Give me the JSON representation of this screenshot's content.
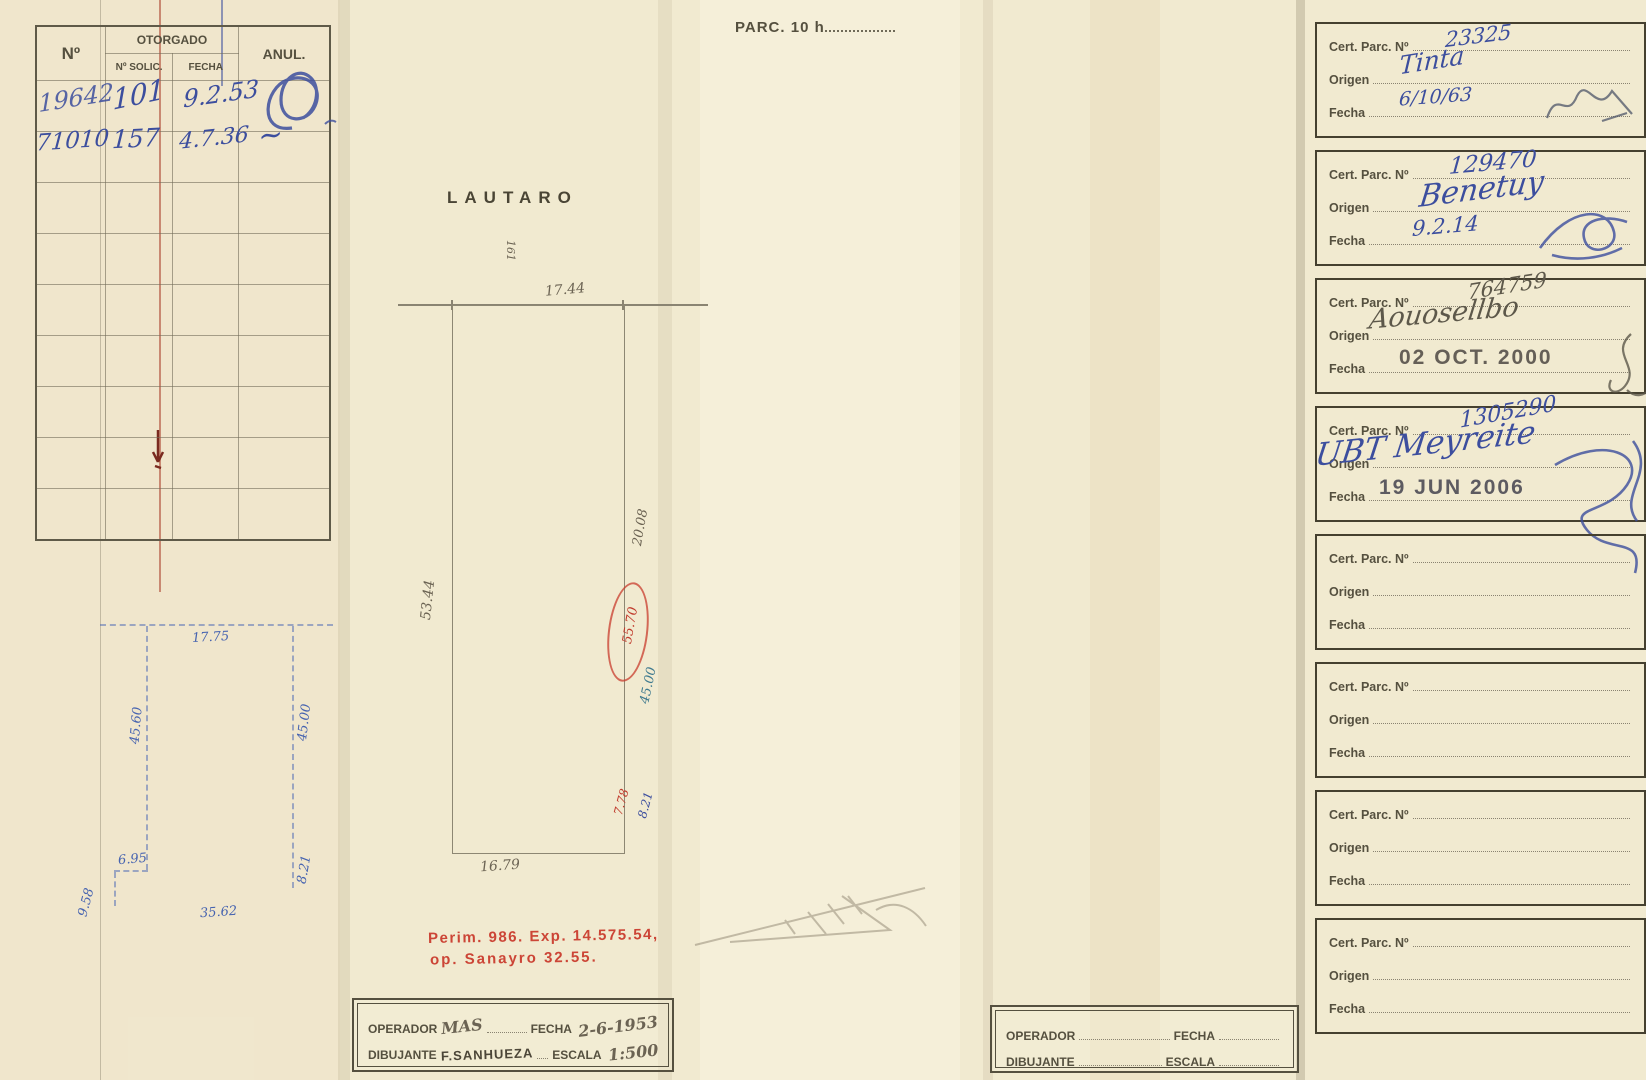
{
  "page": {
    "title": "PARC. 10 h",
    "street_label": "LAUTARO"
  },
  "grant_table": {
    "headers": {
      "no": "Nº",
      "otorgado": "OTORGADO",
      "solic": "Nº SOLIC.",
      "fecha": "FECHA",
      "anul": "ANUL."
    },
    "rows": [
      {
        "no": "19642",
        "solic": "101",
        "fecha": "9.2.53"
      },
      {
        "no": "71010",
        "solic": "157",
        "fecha": "4.7.36",
        "anul": "~"
      }
    ]
  },
  "blue_sketch": {
    "front": "17.75",
    "left_side": "45.60",
    "right_side": "45.00",
    "step": "6.95",
    "right_bottom": "8.21",
    "back": "35.62",
    "left_bottom": "9.58"
  },
  "plan": {
    "street_number": "161",
    "front": "17.44",
    "left_side": "53.44",
    "right_upper": "20.08",
    "right_circled": "55.70",
    "right_lower": "45.00",
    "back_right_red": "7.78",
    "back_right_blue": "8.21",
    "back": "16.79"
  },
  "red_note": {
    "line1": "Perim. 986. Exp. 14.575.54,",
    "line2": "op. Sanayro  32.55."
  },
  "left_operator_box": {
    "operador": "OPERADOR",
    "operador_value": "MAS",
    "fecha": "FECHA",
    "fecha_value": "2-6-1953",
    "dibujante": "DIBUJANTE",
    "dibujante_value": "F.SANHUEZA",
    "escala": "ESCALA",
    "escala_value": "1:500"
  },
  "right_operator_box": {
    "operador": "OPERADOR",
    "fecha": "FECHA",
    "dibujante": "DIBUJANTE",
    "escala": "ESCALA"
  },
  "cert_labels": {
    "cert": "Cert. Parc. Nº",
    "origen": "Origen",
    "fecha": "Fecha"
  },
  "cert_entries": [
    {
      "cert": "23325",
      "origen": "Tinta",
      "fecha": "6/10/63"
    },
    {
      "cert": "129470",
      "origen": "Benetuy",
      "fecha": "9.2.14"
    },
    {
      "cert": "764759",
      "origen": "Aouosellbo",
      "fecha": "02 OCT. 2000"
    },
    {
      "cert": "1305290",
      "origen": "UBT Meyreite",
      "fecha": "19 JUN 2006"
    },
    {
      "cert": "",
      "origen": "",
      "fecha": ""
    },
    {
      "cert": "",
      "origen": "",
      "fecha": ""
    },
    {
      "cert": "",
      "origen": "",
      "fecha": ""
    },
    {
      "cert": "",
      "origen": "",
      "fecha": ""
    }
  ]
}
